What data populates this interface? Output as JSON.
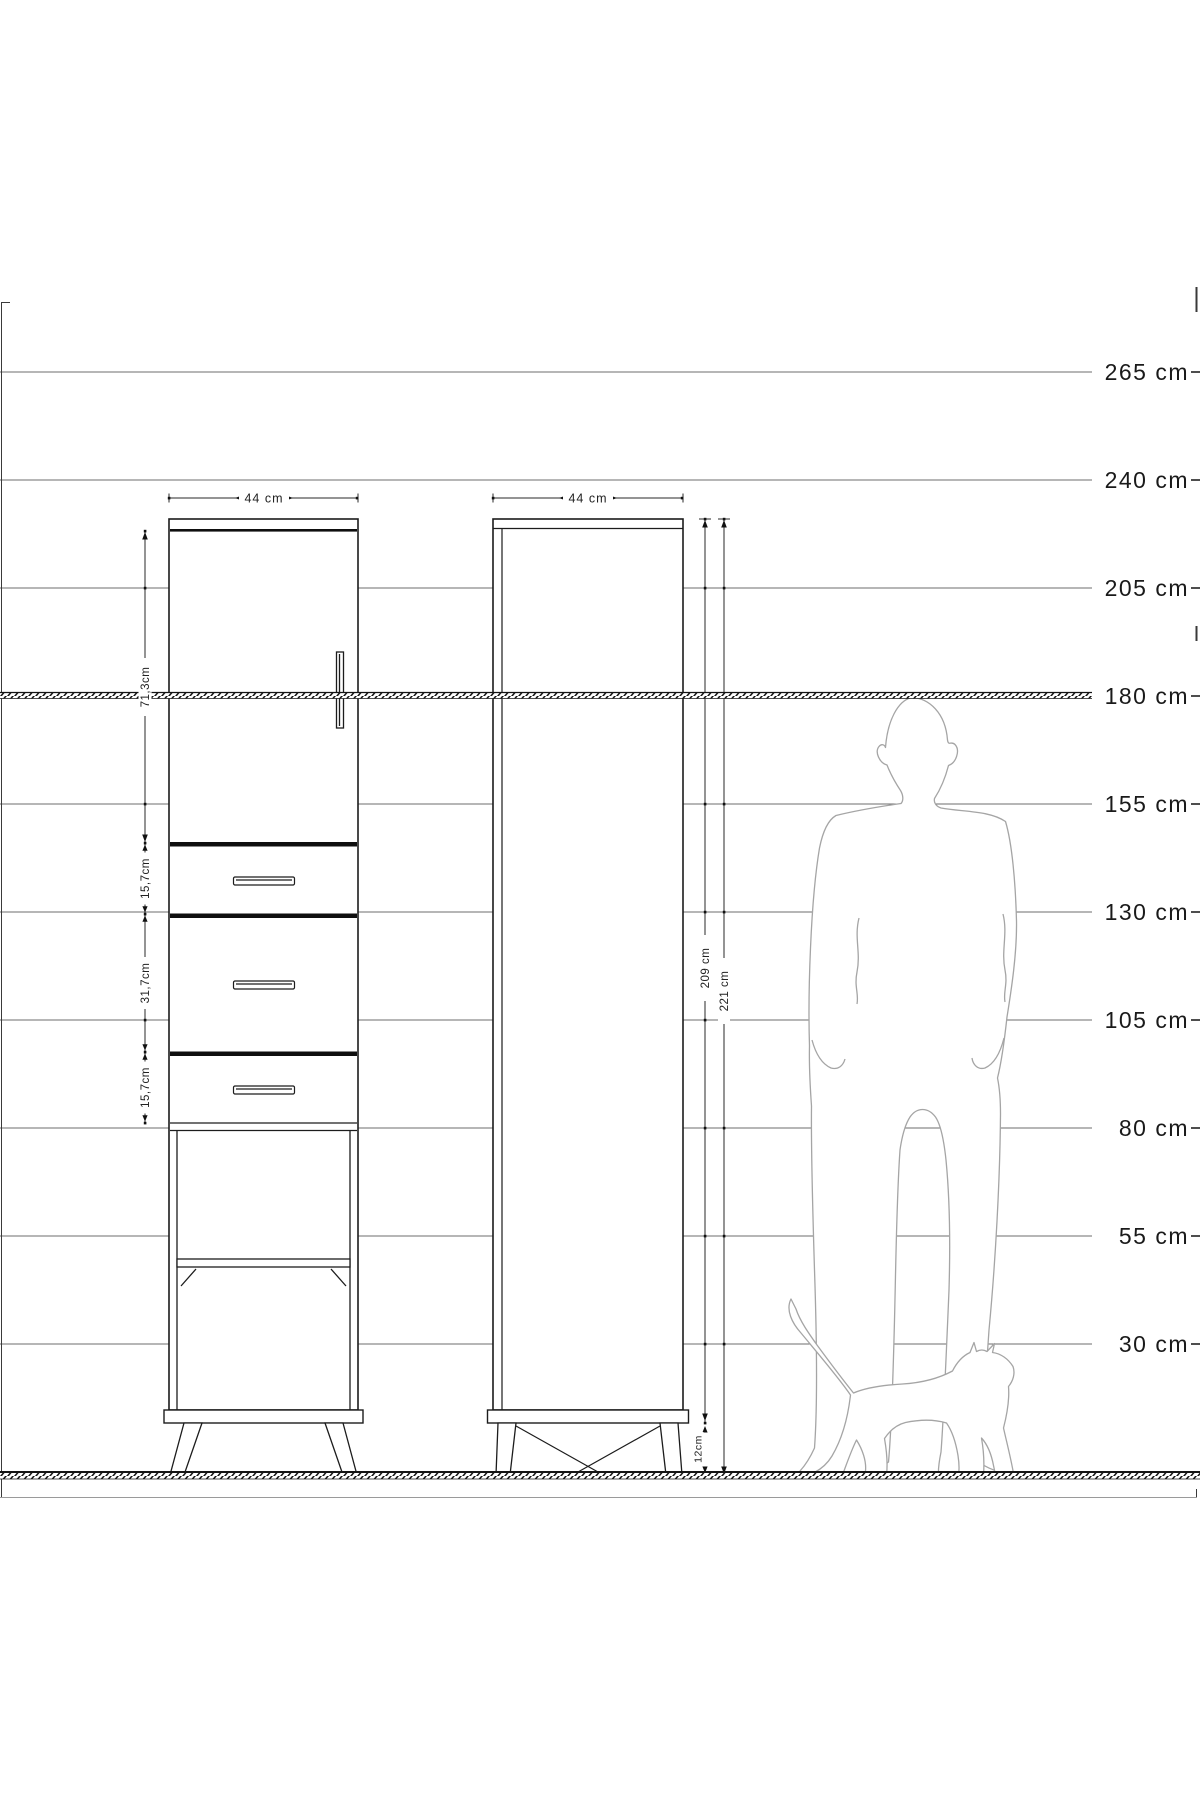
{
  "drawing": {
    "ruler": {
      "labels": [
        "265 cm",
        "240 cm",
        "205 cm",
        "180 cm",
        "155 cm",
        "130 cm",
        "105 cm",
        "80 cm",
        "55 cm",
        "30 cm"
      ]
    },
    "left_cabinet": {
      "width_label": "44 cm",
      "door_height_label": "71,3cm",
      "drawer_heights": [
        "15,7cm",
        "31,7cm",
        "15,7cm"
      ]
    },
    "right_cabinet": {
      "width_label": "44 cm",
      "body_height_label": "209 cm",
      "total_height_label": "221 cm",
      "leg_height_label": "12cm"
    }
  }
}
